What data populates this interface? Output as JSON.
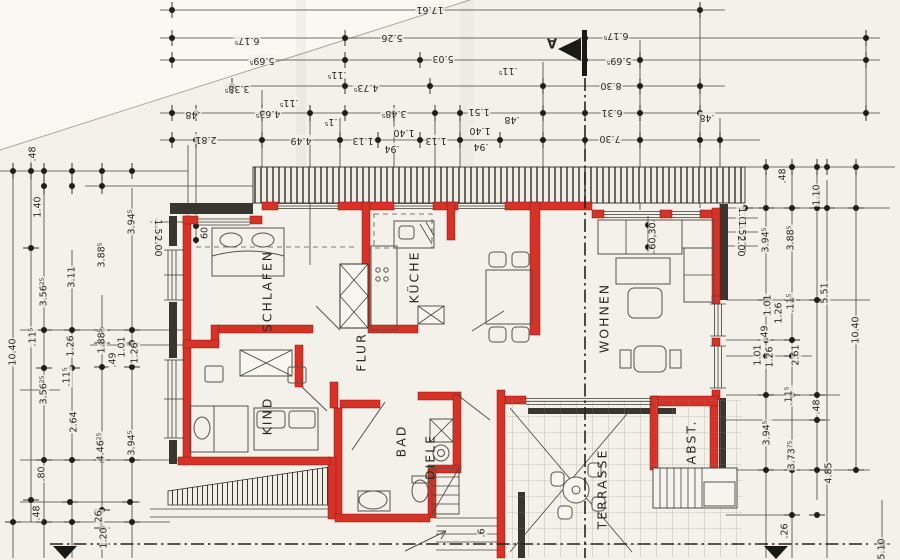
{
  "document": {
    "kind": "architectural floor plan (scanned)",
    "language": "de"
  },
  "colors": {
    "paper": "#f4f1ea",
    "wall_red": "#d63227",
    "ink": "#2b2a25",
    "line": "#45433d"
  },
  "rooms": [
    {
      "label": "SCHLAFEN",
      "x": 267,
      "y": 291,
      "r": 270
    },
    {
      "label": "KÜCHE",
      "x": 414,
      "y": 277,
      "r": 270
    },
    {
      "label": "WOHNEN",
      "x": 604,
      "y": 318,
      "r": 270
    },
    {
      "label": "FLUR",
      "x": 361,
      "y": 352,
      "r": 270
    },
    {
      "label": "KIND",
      "x": 267,
      "y": 416,
      "r": 270
    },
    {
      "label": "BAD",
      "x": 401,
      "y": 441,
      "r": 270
    },
    {
      "label": "DIELE",
      "x": 430,
      "y": 457,
      "r": 270
    },
    {
      "label": "TERRASSE",
      "x": 602,
      "y": 489,
      "r": 270
    },
    {
      "label": "ABST.",
      "x": 691,
      "y": 442,
      "r": 270
    }
  ],
  "section_marker": {
    "t": "A",
    "x": 552,
    "y": 42,
    "r": 180
  },
  "dimensions": [
    {
      "t": "17.61",
      "x": 430,
      "y": 9,
      "r": 180
    },
    {
      "t": "6.17⁵",
      "x": 247,
      "y": 40,
      "r": 180
    },
    {
      "t": "5.26",
      "x": 392,
      "y": 37,
      "r": 180
    },
    {
      "t": "6.17⁵",
      "x": 616,
      "y": 35,
      "r": 180
    },
    {
      "t": "5.69⁵",
      "x": 262,
      "y": 60,
      "r": 180
    },
    {
      "t": "5.03",
      "x": 443,
      "y": 58,
      "r": 180
    },
    {
      "t": "5.69⁵",
      "x": 619,
      "y": 60,
      "r": 180
    },
    {
      "t": "3.38⁵",
      "x": 237,
      "y": 88,
      "r": 180
    },
    {
      "t": ".11⁵",
      "x": 337,
      "y": 74,
      "r": 180
    },
    {
      "t": "4.73⁵",
      "x": 366,
      "y": 87,
      "r": 180
    },
    {
      "t": ".11⁵",
      "x": 508,
      "y": 70,
      "r": 180
    },
    {
      "t": "8.30",
      "x": 611,
      "y": 85,
      "r": 180
    },
    {
      "t": ".48",
      "x": 193,
      "y": 114,
      "r": 180
    },
    {
      "t": "4.63⁵",
      "x": 268,
      "y": 113,
      "r": 180
    },
    {
      "t": ".11⁵",
      "x": 289,
      "y": 102,
      "r": 180
    },
    {
      "t": ".1⁵",
      "x": 331,
      "y": 121,
      "r": 180
    },
    {
      "t": "3.48⁵",
      "x": 394,
      "y": 113,
      "r": 180
    },
    {
      "t": "1.51",
      "x": 479,
      "y": 111,
      "r": 180
    },
    {
      "t": ".48",
      "x": 512,
      "y": 119,
      "r": 180
    },
    {
      "t": "6.31",
      "x": 612,
      "y": 112,
      "r": 180
    },
    {
      "t": ".48",
      "x": 707,
      "y": 117,
      "r": 180
    },
    {
      "t": "2.81",
      "x": 206,
      "y": 139,
      "r": 180
    },
    {
      "t": "4.49",
      "x": 301,
      "y": 140,
      "r": 180
    },
    {
      "t": "1.13",
      "x": 363,
      "y": 140,
      "r": 180
    },
    {
      "t": "1.40",
      "x": 404,
      "y": 132,
      "r": 180
    },
    {
      "t": ".94",
      "x": 392,
      "y": 148,
      "r": 180
    },
    {
      "t": "1.13",
      "x": 436,
      "y": 140,
      "r": 180
    },
    {
      "t": "1.40",
      "x": 480,
      "y": 130,
      "r": 180
    },
    {
      "t": ".94",
      "x": 481,
      "y": 146,
      "r": 180
    },
    {
      "t": "7.30",
      "x": 610,
      "y": 138,
      "r": 180
    },
    {
      "t": ".48",
      "x": 33,
      "y": 154,
      "r": 270
    },
    {
      "t": "1.40",
      "x": 38,
      "y": 207,
      "r": 270
    },
    {
      "t": "3.56²⁵",
      "x": 44,
      "y": 292,
      "r": 270
    },
    {
      "t": "3.11",
      "x": 72,
      "y": 277,
      "r": 270
    },
    {
      "t": "3.88⁵",
      "x": 102,
      "y": 255,
      "r": 270
    },
    {
      "t": "3.94⁵",
      "x": 132,
      "y": 222,
      "r": 270
    },
    {
      "t": "1.50",
      "x": 157,
      "y": 230,
      "r": 90
    },
    {
      "t": "2.00",
      "x": 157,
      "y": 246,
      "r": 90
    },
    {
      "t": "10.40",
      "x": 13,
      "y": 352,
      "r": 270
    },
    {
      "t": ".11⁵",
      "x": 33,
      "y": 337,
      "r": 270
    },
    {
      "t": "1.26",
      "x": 71,
      "y": 346,
      "r": 270
    },
    {
      "t": ".11⁵",
      "x": 67,
      "y": 377,
      "r": 270
    },
    {
      "t": "1.88⁵",
      "x": 102,
      "y": 341,
      "r": 270
    },
    {
      "t": "1.01",
      "x": 122,
      "y": 347,
      "r": 270
    },
    {
      "t": ".49",
      "x": 113,
      "y": 360,
      "r": 270
    },
    {
      "t": "1.26",
      "x": 135,
      "y": 353,
      "r": 270
    },
    {
      "t": "3.56²⁵",
      "x": 44,
      "y": 390,
      "r": 270
    },
    {
      "t": "2.64",
      "x": 74,
      "y": 422,
      "r": 270
    },
    {
      "t": "4.46²⁵",
      "x": 101,
      "y": 447,
      "r": 270
    },
    {
      "t": "3.94⁵",
      "x": 132,
      "y": 443,
      "r": 270
    },
    {
      "t": ".80",
      "x": 42,
      "y": 474,
      "r": 270
    },
    {
      "t": ".48",
      "x": 37,
      "y": 513,
      "r": 270
    },
    {
      "t": ".26",
      "x": 99,
      "y": 518,
      "r": 270
    },
    {
      "t": "1.20",
      "x": 104,
      "y": 538,
      "r": 270
    },
    {
      "t": ".48",
      "x": 783,
      "y": 176,
      "r": 270
    },
    {
      "t": "1.10",
      "x": 817,
      "y": 195,
      "r": 270
    },
    {
      "t": "3.94⁵",
      "x": 766,
      "y": 240,
      "r": 270
    },
    {
      "t": "3.88⁵",
      "x": 791,
      "y": 238,
      "r": 270
    },
    {
      "t": "1.00",
      "x": 741,
      "y": 218,
      "r": 90
    },
    {
      "t": "1.50",
      "x": 741,
      "y": 231,
      "r": 90
    },
    {
      "t": "2.00",
      "x": 740,
      "y": 246,
      "r": 90
    },
    {
      "t": "5.51",
      "x": 825,
      "y": 293,
      "r": 270
    },
    {
      "t": "10.40",
      "x": 856,
      "y": 330,
      "r": 270
    },
    {
      "t": "1.01",
      "x": 768,
      "y": 305,
      "r": 270
    },
    {
      "t": "1.26",
      "x": 779,
      "y": 313,
      "r": 270
    },
    {
      "t": ".11⁵",
      "x": 791,
      "y": 303,
      "r": 270
    },
    {
      "t": ".49",
      "x": 765,
      "y": 333,
      "r": 270
    },
    {
      "t": "1.01",
      "x": 758,
      "y": 355,
      "r": 270
    },
    {
      "t": "1.26",
      "x": 770,
      "y": 357,
      "r": 270
    },
    {
      "t": "2.61",
      "x": 796,
      "y": 355,
      "r": 270
    },
    {
      "t": "3.94⁵",
      "x": 767,
      "y": 433,
      "r": 270
    },
    {
      "t": "3.73⁷⁵",
      "x": 792,
      "y": 455,
      "r": 270
    },
    {
      "t": "4.85",
      "x": 829,
      "y": 473,
      "r": 270
    },
    {
      "t": ".11⁵",
      "x": 789,
      "y": 396,
      "r": 270
    },
    {
      "t": ".48",
      "x": 817,
      "y": 407,
      "r": 270
    },
    {
      "t": ".26",
      "x": 785,
      "y": 531,
      "r": 270
    },
    {
      "t": "5.10",
      "x": 882,
      "y": 549,
      "r": 270
    },
    {
      "t": "60",
      "x": 205,
      "y": 233,
      "r": 270
    },
    {
      "t": "60,30",
      "x": 653,
      "y": 236,
      "r": 270
    },
    {
      "t": ".6",
      "x": 482,
      "y": 533,
      "r": 270
    }
  ]
}
